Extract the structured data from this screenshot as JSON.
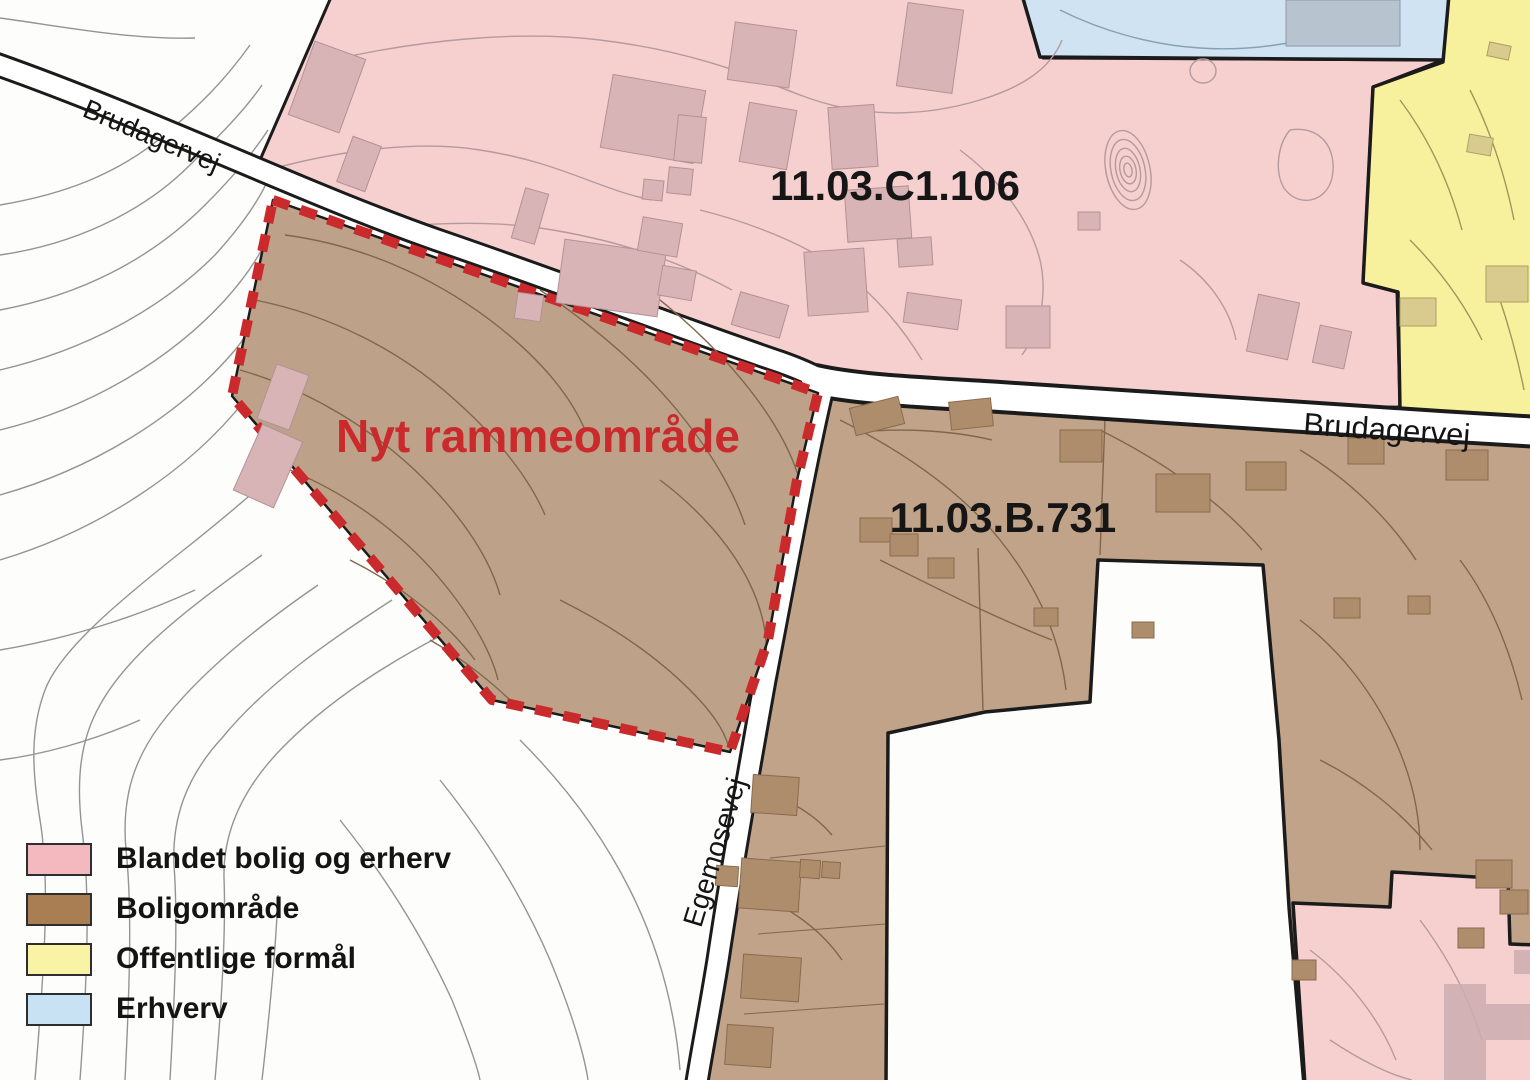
{
  "zones": {
    "mixed": {
      "id": "11.03.C1.106",
      "fill": "#f6cfcf"
    },
    "residential": {
      "id": "11.03.B.731",
      "fill": "#c0a388"
    },
    "public": {
      "fill": "#f7f19d"
    },
    "business": {
      "fill": "#cfe3f2"
    }
  },
  "highlight": {
    "label": "Nyt rammeområde",
    "fill": "#bda189",
    "outline": "#cb2a2d"
  },
  "roads": {
    "brudagervej_nw": "Brudagervej",
    "brudagervej_e": "Brudagervej",
    "egemosevej": "Egemosevej"
  },
  "legend": {
    "items": [
      {
        "label": "Blandet bolig og erherv",
        "color": "#f4b9be"
      },
      {
        "label": "Boligområde",
        "color": "#a97e53"
      },
      {
        "label": "Offentlige formål",
        "color": "#f9f4a5"
      },
      {
        "label": "Erhverv",
        "color": "#c8e2f3"
      }
    ]
  },
  "colors": {
    "building_mixed": "#d8b4b7",
    "building_residential": "#ae8d6d",
    "building_public": "#d9cb8d",
    "building_business": "#b7c3cf",
    "building_bottom_pink": "#cdaeb2",
    "line_black": "#1b1b1b",
    "contour_gray": "#8f8f8b",
    "label_text": "#161616"
  }
}
